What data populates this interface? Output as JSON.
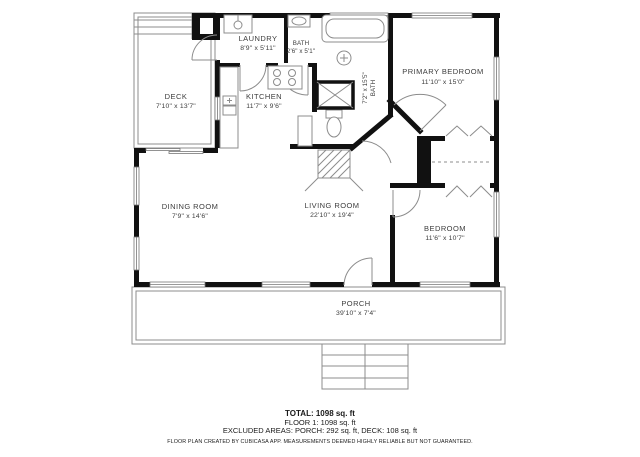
{
  "plan": {
    "rooms": {
      "laundry": {
        "name": "LAUNDRY",
        "dims": "8'9\" x 5'11\""
      },
      "bath_small": {
        "name": "BATH",
        "dims": "2'6\" x 5'1\""
      },
      "bath_main": {
        "name": "BATH",
        "dims": "7'2\" x 15'5\""
      },
      "primary_bedroom": {
        "name": "PRIMARY BEDROOM",
        "dims": "11'10\" x 15'0\""
      },
      "kitchen": {
        "name": "KITCHEN",
        "dims": "11'7\" x 9'6\""
      },
      "deck": {
        "name": "DECK",
        "dims": "7'10\" x 13'7\""
      },
      "dining_room": {
        "name": "DINING ROOM",
        "dims": "7'9\" x 14'6\""
      },
      "living_room": {
        "name": "LIVING ROOM",
        "dims": "22'10\" x 19'4\""
      },
      "bedroom": {
        "name": "BEDROOM",
        "dims": "11'6\" x 10'7\""
      },
      "porch": {
        "name": "PORCH",
        "dims": "39'10\" x 7'4\""
      }
    },
    "colors": {
      "wall": "#111111",
      "line": "#8c8c8c",
      "text": "#3d3d3d"
    }
  },
  "footer": {
    "total": "TOTAL: 1098 sq. ft",
    "floor": "FLOOR 1: 1098 sq. ft",
    "excluded": "EXCLUDED AREAS: PORCH: 292 sq. ft, DECK: 108 sq. ft",
    "disclaimer": "FLOOR PLAN CREATED BY CUBICASA APP. MEASUREMENTS DEEMED HIGHLY RELIABLE BUT NOT GUARANTEED."
  }
}
